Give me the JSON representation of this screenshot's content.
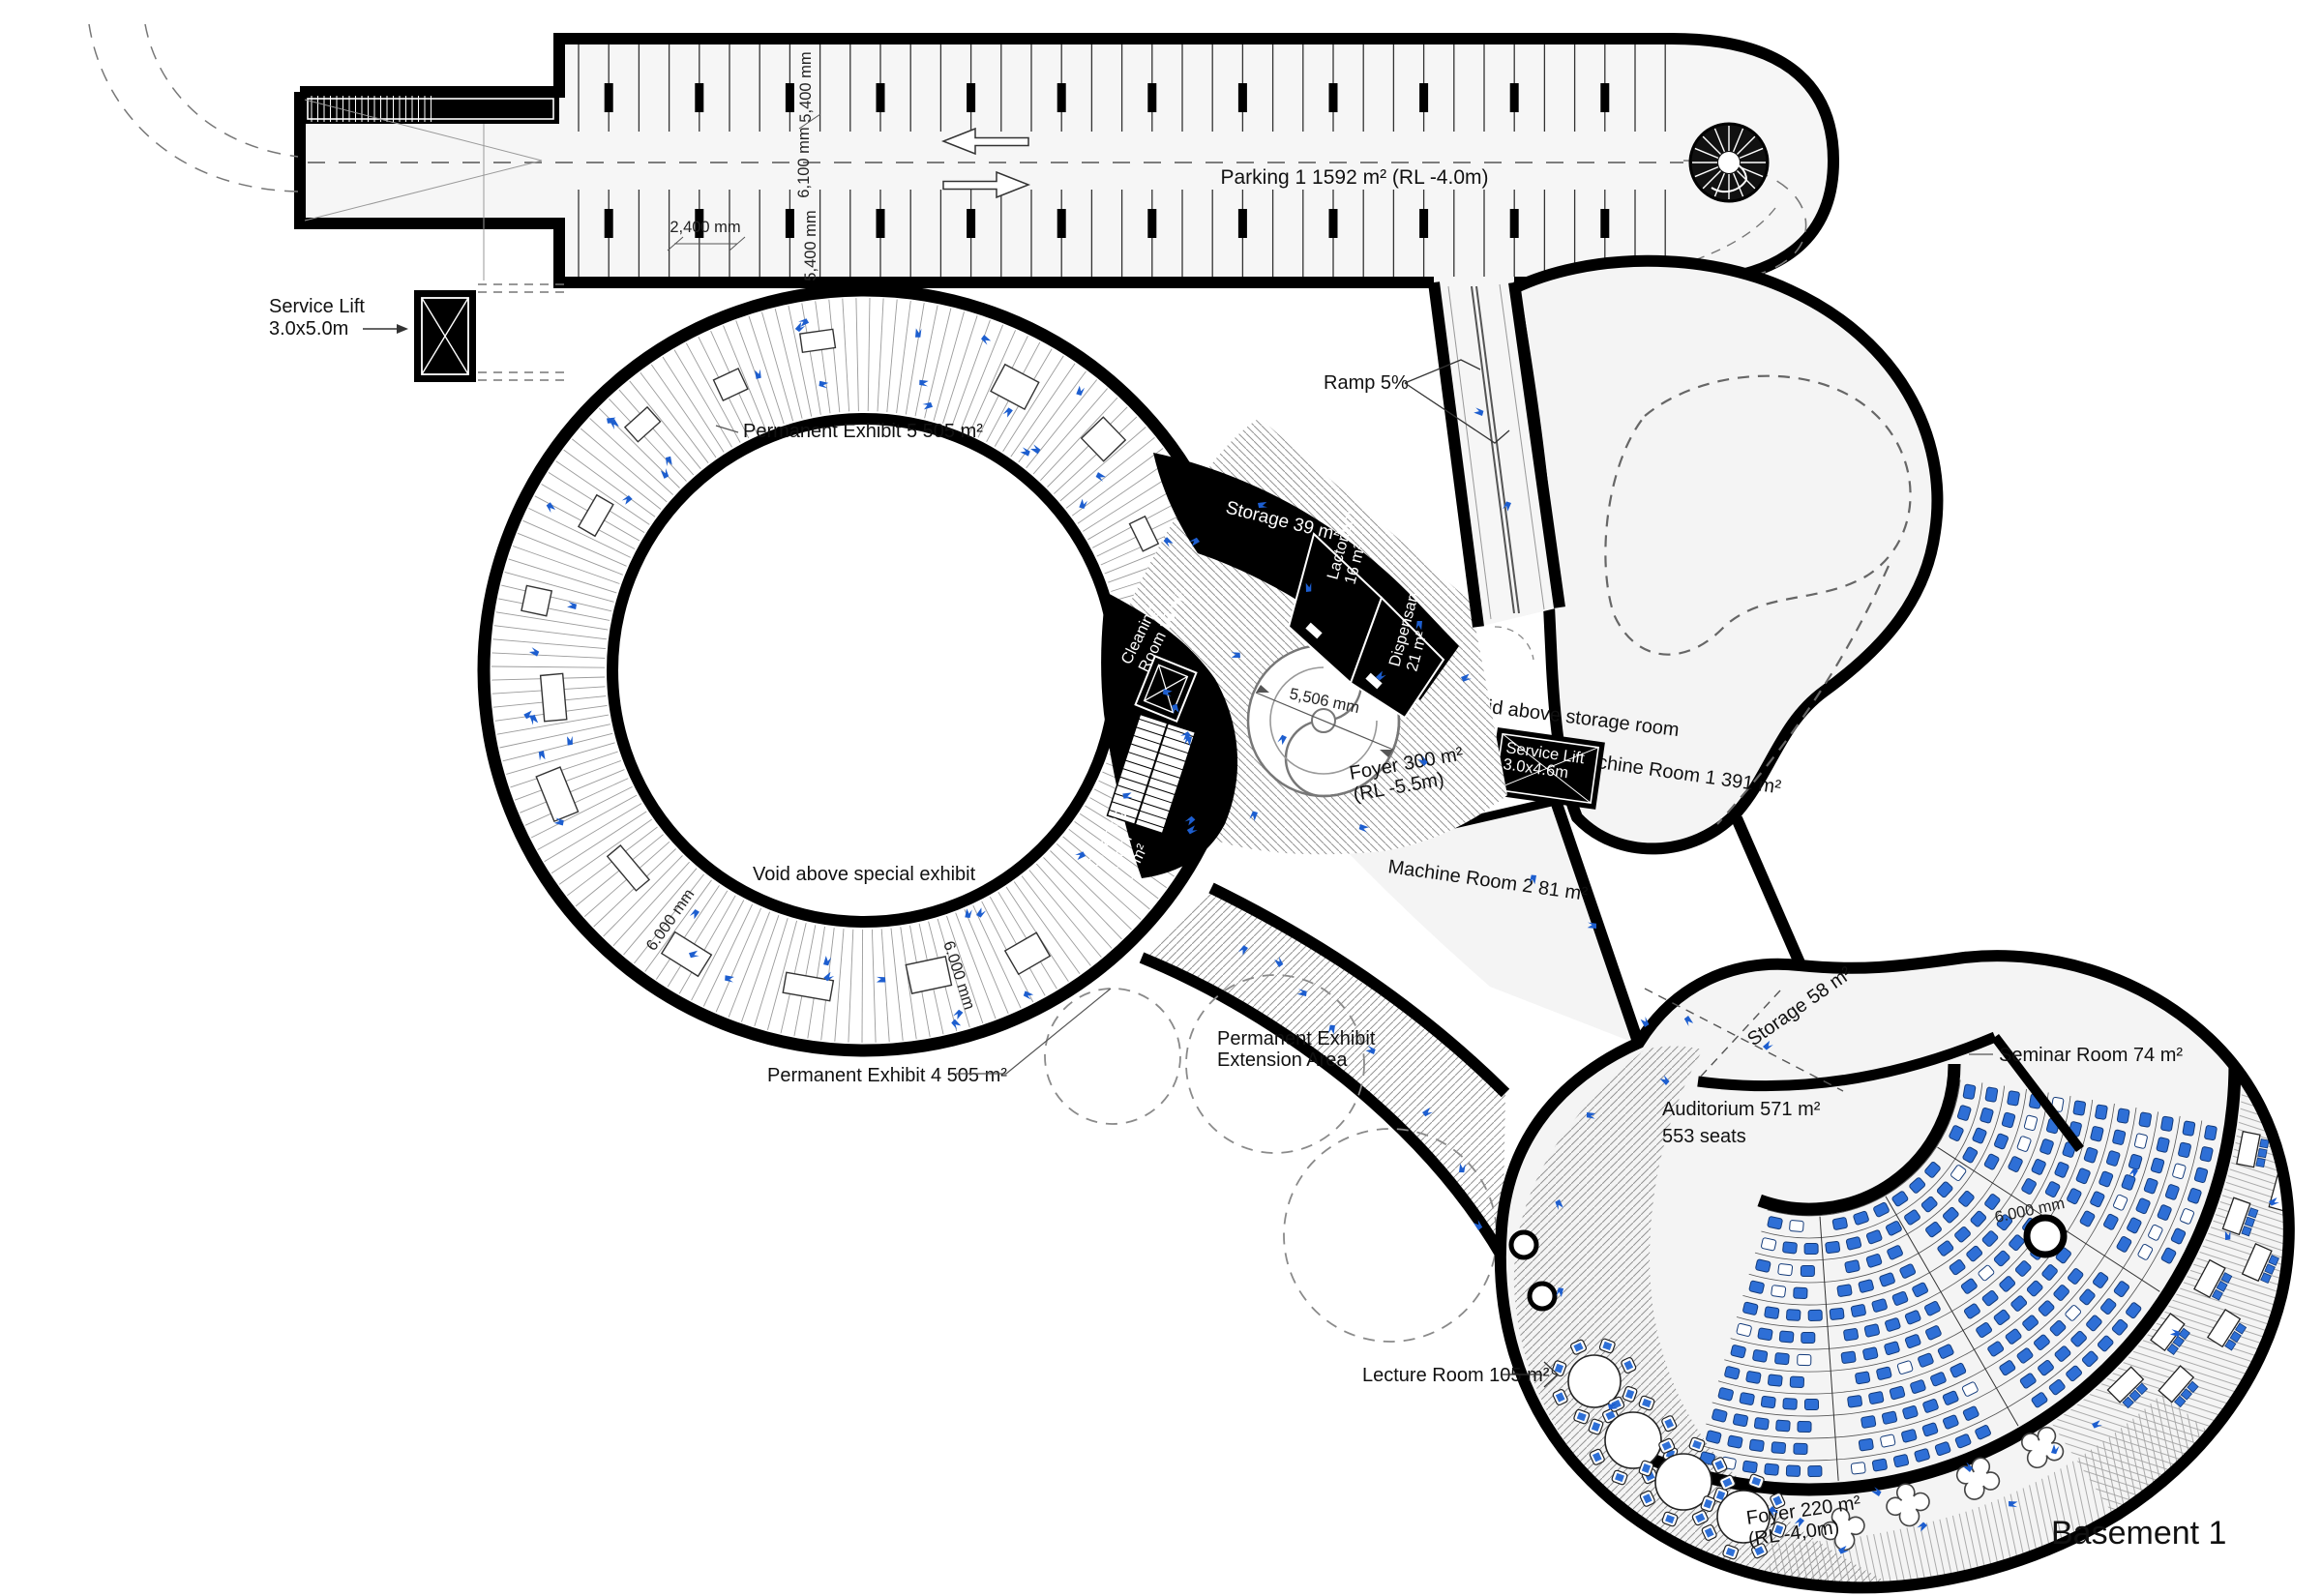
{
  "title": "Basement 1",
  "colors": {
    "wall": "#000000",
    "seat_blue": "#2e6fd6",
    "arrow_blue": "#1d5ecf",
    "light_fill": "#f4f4f4"
  },
  "rooms": {
    "parking": {
      "label": "Parking 1    1592 m²    (RL -4.0m)"
    },
    "service_lift_1": {
      "line1": "Service Lift",
      "line2": "3.0x5.0m"
    },
    "permanent_exhibit_5": {
      "label": "Permanent Exhibit 5  505 m²"
    },
    "ramp": {
      "label": "Ramp 5%"
    },
    "storage_39": {
      "label": "Storage  39 m²"
    },
    "lactorium": {
      "line1": "Lactorium",
      "line2": "16 m²"
    },
    "dispensary": {
      "line1": "Dispensary",
      "line2": "21 m²"
    },
    "cleaning_room_16": {
      "line1": "Cleaning",
      "line2": "Room 16 m²"
    },
    "cleaning_room_14": {
      "line1": "Cleaning",
      "line2": "Room",
      "line3": "14 m²"
    },
    "foyer_300": {
      "line1": "Foyer  300 m²",
      "line2": "(RL -5.5m)"
    },
    "service_lift_2": {
      "line1": "Service Lift",
      "line2": "3.0x4.6m"
    },
    "void_storage": {
      "label": "Void above storage room"
    },
    "machine_room_1": {
      "label": "Machine Room 1  391 m²"
    },
    "machine_room_2": {
      "label": "Machine Room 2  81 m²"
    },
    "void_special": {
      "label": "Void above special exhibit"
    },
    "permanent_exhibit_4": {
      "label": "Permanent Exhibit 4  505 m²"
    },
    "extension_area": {
      "line1": "Permanent Exhibit",
      "line2": "Extension Area"
    },
    "storage_58": {
      "label": "Storage  58 m²"
    },
    "seminar": {
      "label": "Seminar Room 74 m²"
    },
    "auditorium": {
      "line1": "Auditorium 571 m²",
      "line2": "553 seats"
    },
    "lecture": {
      "label": "Lecture Room 105 m²"
    },
    "foyer_220": {
      "line1": "Foyer 220 m²",
      "line2": "(RL -4,0m)"
    }
  },
  "dimensions": {
    "parking_bay_top": "5,400 mm",
    "parking_aisle": "6,100 mm",
    "parking_bay_bottom": "5,400 mm",
    "parking_stall": "2,400 mm",
    "stair_diameter": "5,506 mm",
    "exhibit_width_a": "6.000 mm",
    "exhibit_width_b": "6.000 mm",
    "seminar_width": "6.000 mm"
  }
}
